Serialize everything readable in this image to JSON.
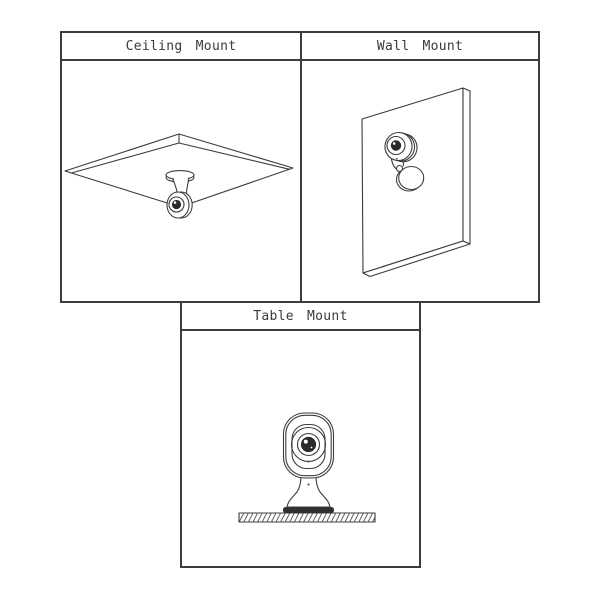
{
  "figure": {
    "panels": [
      {
        "id": "ceiling",
        "title": "Ceiling Mount"
      },
      {
        "id": "wall",
        "title": "Wall Mount"
      },
      {
        "id": "table",
        "title": "Table Mount"
      }
    ]
  },
  "icons": {
    "ceiling_illustration": "camera-hanging-from-ceiling-slab",
    "wall_illustration": "camera-on-wall-panel",
    "table_illustration": "camera-standing-on-hatched-table"
  },
  "colors": {
    "line": "#3c3c3c",
    "background": "#ffffff",
    "lens_fill": "#2a2a2a",
    "base_plate_fill": "#303030"
  }
}
